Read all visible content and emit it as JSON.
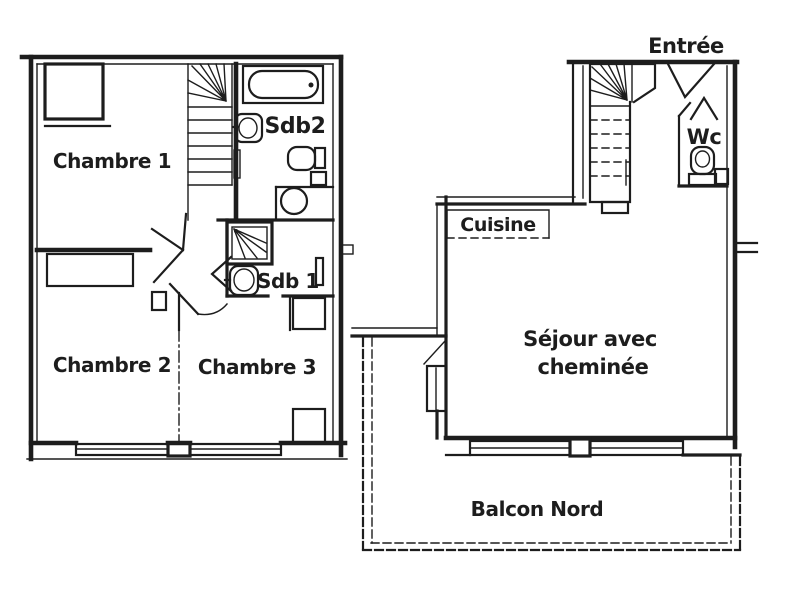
{
  "colors": {
    "ink": "#1d1d1d",
    "paper": "#ffffff"
  },
  "upper_floor": {
    "chambre1": "Chambre 1",
    "chambre2": "Chambre 2",
    "chambre3": "Chambre 3",
    "sdb2": "Sdb2",
    "sdb1": "Sdb 1"
  },
  "main_floor": {
    "entree": "Entrée",
    "wc": "Wc",
    "cuisine": "Cuisine",
    "sejour_line1": "Séjour avec",
    "sejour_line2": "cheminée",
    "balcon": "Balcon Nord"
  }
}
